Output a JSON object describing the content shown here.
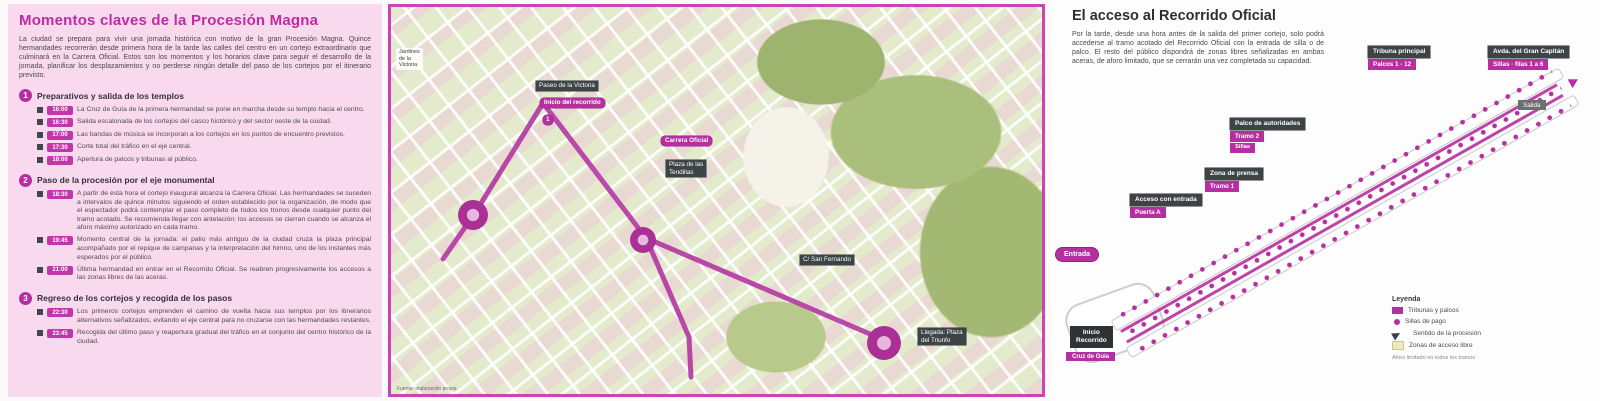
{
  "colors": {
    "accent": "#b62fa0",
    "panel_pink": "#f8d9ee",
    "label_dark": "#3e4345"
  },
  "left_panel": {
    "title": "Momentos claves de la Procesión Magna",
    "intro": "La ciudad se prepara para vivir una jornada histórica con motivo de la gran Procesión Magna. Quince hermandades recorrerán desde primera hora de la tarde las calles del centro en un cortejo extraordinario que culminará en la Carrera Oficial. Estos son los momentos y los horarios clave para seguir el desarrollo de la jornada, planificar los desplazamientos y no perderse ningún detalle del paso de los cortejos por el itinerario previsto.",
    "sections": [
      {
        "num": "1",
        "heading": "Preparativos y salida de los templos",
        "items": [
          {
            "time": "16:00",
            "text": "La Cruz de Guía de la primera hermandad se pone en marcha desde su templo hacia el centro."
          },
          {
            "time": "16:30",
            "text": "Salida escalonada de los cortejos del casco histórico y del sector oeste de la ciudad."
          },
          {
            "time": "17:00",
            "text": "Las bandas de música se incorporan a los cortejos en los puntos de encuentro previstos."
          },
          {
            "time": "17:30",
            "text": "Corte total del tráfico en el eje central."
          },
          {
            "time": "18:00",
            "text": "Apertura de palcos y tribunas al público."
          }
        ]
      },
      {
        "num": "2",
        "heading": "Paso de la procesión por el eje monumental",
        "items": [
          {
            "time": "18:30",
            "text": "A partir de esta hora el cortejo inaugural alcanza la Carrera Oficial. Las hermandades se suceden a intervalos de quince minutos siguiendo el orden establecido por la organización, de modo que el espectador podrá contemplar el paso completo de todos los tronos desde cualquier punto del tramo acotado. Se recomienda llegar con antelación: los accesos se cierran cuando se alcanza el aforo máximo autorizado en cada tramo."
          },
          {
            "time": "19:45",
            "text": "Momento central de la jornada: el palio más antiguo de la ciudad cruza la plaza principal acompañado por el repique de campanas y la interpretación del himno, uno de los instantes más esperados por el público."
          },
          {
            "time": "21:00",
            "text": "Última hermandad en entrar en el Recorrido Oficial. Se reabren progresivamente los accesos a las zonas libres de las aceras."
          }
        ]
      },
      {
        "num": "3",
        "heading": "Regreso de los cortejos y recogida de los pasos",
        "items": [
          {
            "time": "22:30",
            "text": "Los primeros cortejos emprenden el camino de vuelta hacia sus templos por los itinerarios alternativos señalizados, evitando el eje central para no cruzarse con las hermandades restantes."
          },
          {
            "time": "23:45",
            "text": "Recogida del último paso y reapertura gradual del tráfico en el conjunto del centro histórico de la ciudad."
          }
        ]
      }
    ]
  },
  "map": {
    "park_label": [
      "Jardines",
      "de la",
      "Victoria"
    ],
    "street_start": "Paseo de la Victoria",
    "route_start": "Inicio del recorrido",
    "tag": "1",
    "official": "Carrera Oficial",
    "plaza_line1": "Plaza de las",
    "plaza_line2": "Tendillas",
    "street_mid": "C/ San Fernando",
    "end_line1": "Llegada: Plaza",
    "end_line2": "del Triunfo",
    "credit": "Fuente: elaboración propia"
  },
  "right_panel": {
    "title": "El acceso al Recorrido Oficial",
    "intro": "Por la tarde, desde una hora antes de la salida del primer cortejo, solo podrá accederse al tramo acotado del Recorrido Oficial con la entrada de silla o de palco. El resto del público dispondrá de zonas libres señalizadas en ambas aceras, de aforo limitado, que se cerrarán una vez completada su capacidad.",
    "diagram": {
      "stack_a_dark": "Tribuna principal",
      "stack_a_mag": "Palcos 1 - 12",
      "stack_b_dark": "Avda. del Gran Capitán",
      "stack_b_mag": "Sillas · filas 1 a 6",
      "stack_c_dark": "Palco de autoridades",
      "stack_c_mag": "Tramo 2",
      "stack_c_mag2": "Sillas",
      "stack_d_dark": "Zona de prensa",
      "stack_d_mag": "Tramo 1",
      "stack_e_dark": "Acceso con entrada",
      "stack_e_mag": "Puerta A",
      "entry_pill": "Entrada",
      "exit_label": "Salida",
      "start_line1": "Inicio",
      "start_line2": "Recorrido",
      "start_mag": "Cruz de Guía"
    },
    "legend": {
      "title": "Leyenda",
      "items": [
        {
          "label": "Tribunas y palcos"
        },
        {
          "label": "Sillas de pago"
        },
        {
          "label": "Sentido de la procesión"
        },
        {
          "label": "Zonas de acceso libre"
        }
      ],
      "note": "Aforo limitado en todos los tramos"
    }
  }
}
